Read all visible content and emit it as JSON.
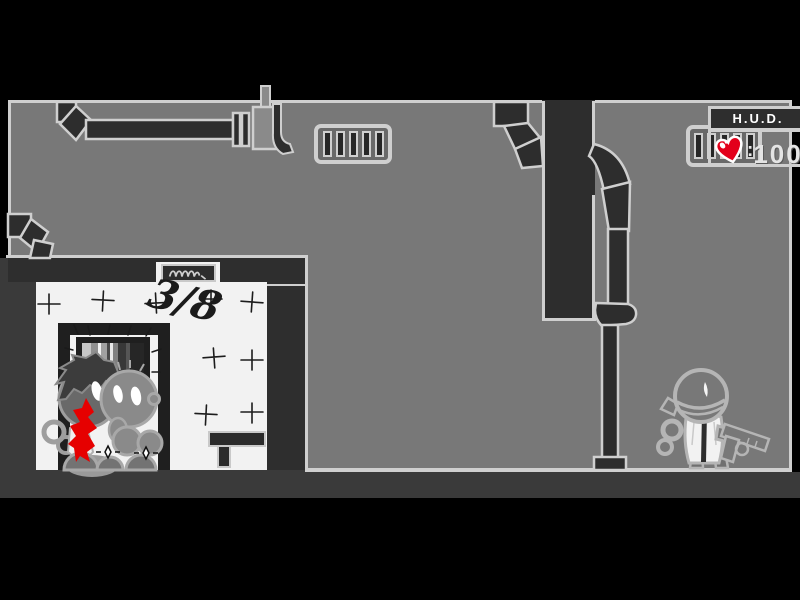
{
  "game": {
    "hud": {
      "title": "H.U.D.",
      "health_separator": ":",
      "health_value": "100",
      "heart_icon": "heart-icon",
      "heart_color": "#e3001b"
    },
    "white_room": {
      "graffiti_count": "3/8",
      "sign_plaque_icon": "squiggle-sign"
    },
    "palette": {
      "background_black": "#000000",
      "wall_gray": "#787878",
      "outline_light": "#cfcfcf",
      "dark_zone": "#3a3a3a",
      "duct_dark": "#2d2d2d",
      "room_white": "#f2f2f2",
      "blood_red": "#e60000",
      "corpse_gray": "#8a8a8a"
    }
  }
}
